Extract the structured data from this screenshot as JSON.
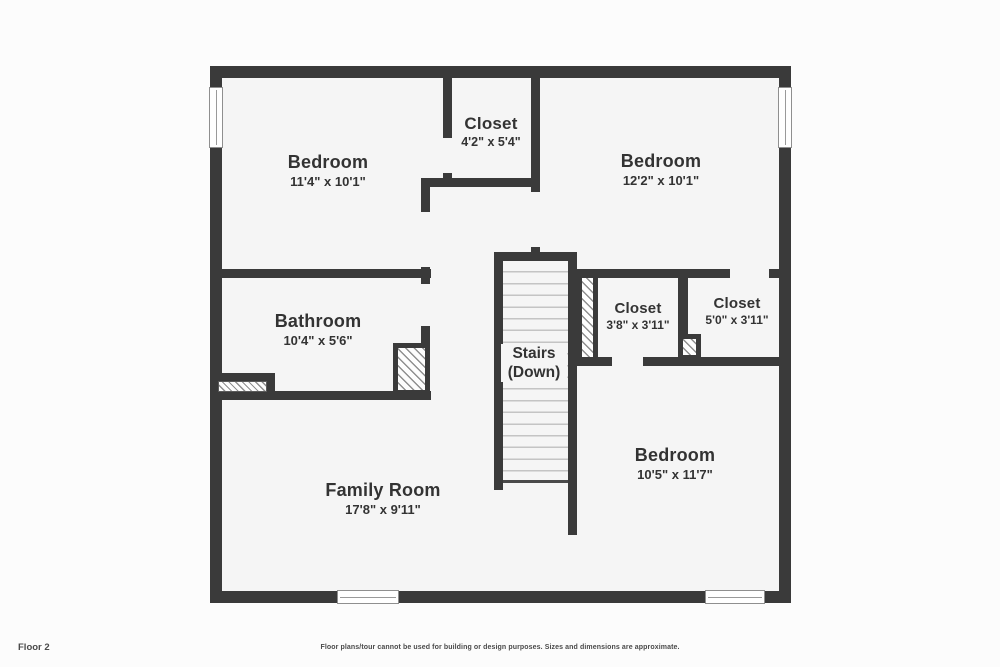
{
  "page": {
    "footer_left": "Floor 2",
    "footer_center": "Floor plans/tour cannot be used for building or design purposes. Sizes and dimensions are approximate."
  },
  "palette": {
    "wall": "#3a3a3a",
    "floor_fill": "#f5f5f5",
    "page_background": "#fcfcfc",
    "text": "#333333",
    "stair_tread": "#c4c4c4",
    "hatch_line": "#8f8f8f"
  },
  "rooms": [
    {
      "id": "bedroom-top-left",
      "name": "Bedroom",
      "dims": "11'4\" x 10'1\""
    },
    {
      "id": "closet-top",
      "name": "Closet",
      "dims": "4'2\" x 5'4\""
    },
    {
      "id": "bedroom-top-right",
      "name": "Bedroom",
      "dims": "12'2\" x 10'1\""
    },
    {
      "id": "bathroom",
      "name": "Bathroom",
      "dims": "10'4\" x 5'6\""
    },
    {
      "id": "stairs",
      "name": "Stairs",
      "dims": "(Down)"
    },
    {
      "id": "closet-mid",
      "name": "Closet",
      "dims": "3'8\" x 3'11\""
    },
    {
      "id": "closet-right",
      "name": "Closet",
      "dims": "5'0\" x 3'11\""
    },
    {
      "id": "bedroom-bottom-right",
      "name": "Bedroom",
      "dims": "10'5\" x 11'7\""
    },
    {
      "id": "family-room",
      "name": "Family Room",
      "dims": "17'8\" x 9'11\""
    }
  ]
}
